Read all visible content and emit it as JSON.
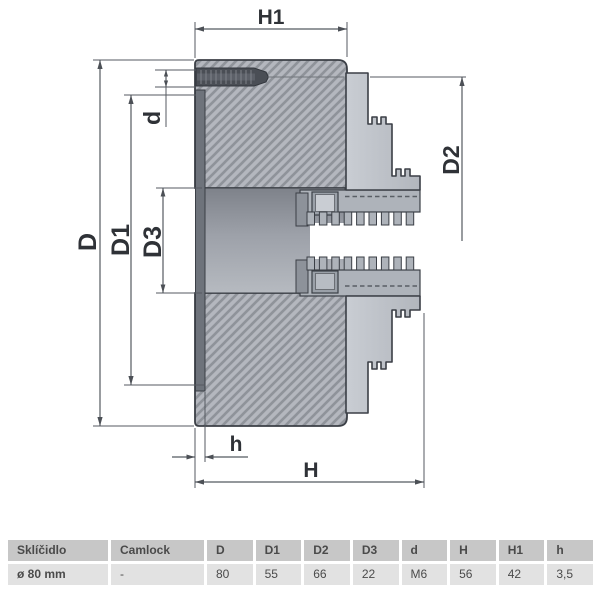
{
  "drawing": {
    "labels": {
      "H1": "H1",
      "D": "D",
      "D1": "D1",
      "D3": "D3",
      "d": "d",
      "D2": "D2",
      "h": "h",
      "H": "H"
    }
  },
  "table": {
    "headers": [
      "Sklíčidlo",
      "Camlock",
      "D",
      "D1",
      "D2",
      "D3",
      "d",
      "H",
      "H1",
      "h"
    ],
    "row": [
      "ø 80 mm",
      "-",
      "80",
      "55",
      "66",
      "22",
      "M6",
      "56",
      "42",
      "3,5"
    ]
  },
  "colors": {
    "table_header_bg": "#c7c7c7",
    "table_row_bg": "#e2e2e2",
    "body_fill": "#b4b7be",
    "hatch_line": "#8f939a",
    "outline": "#3b3f46"
  }
}
